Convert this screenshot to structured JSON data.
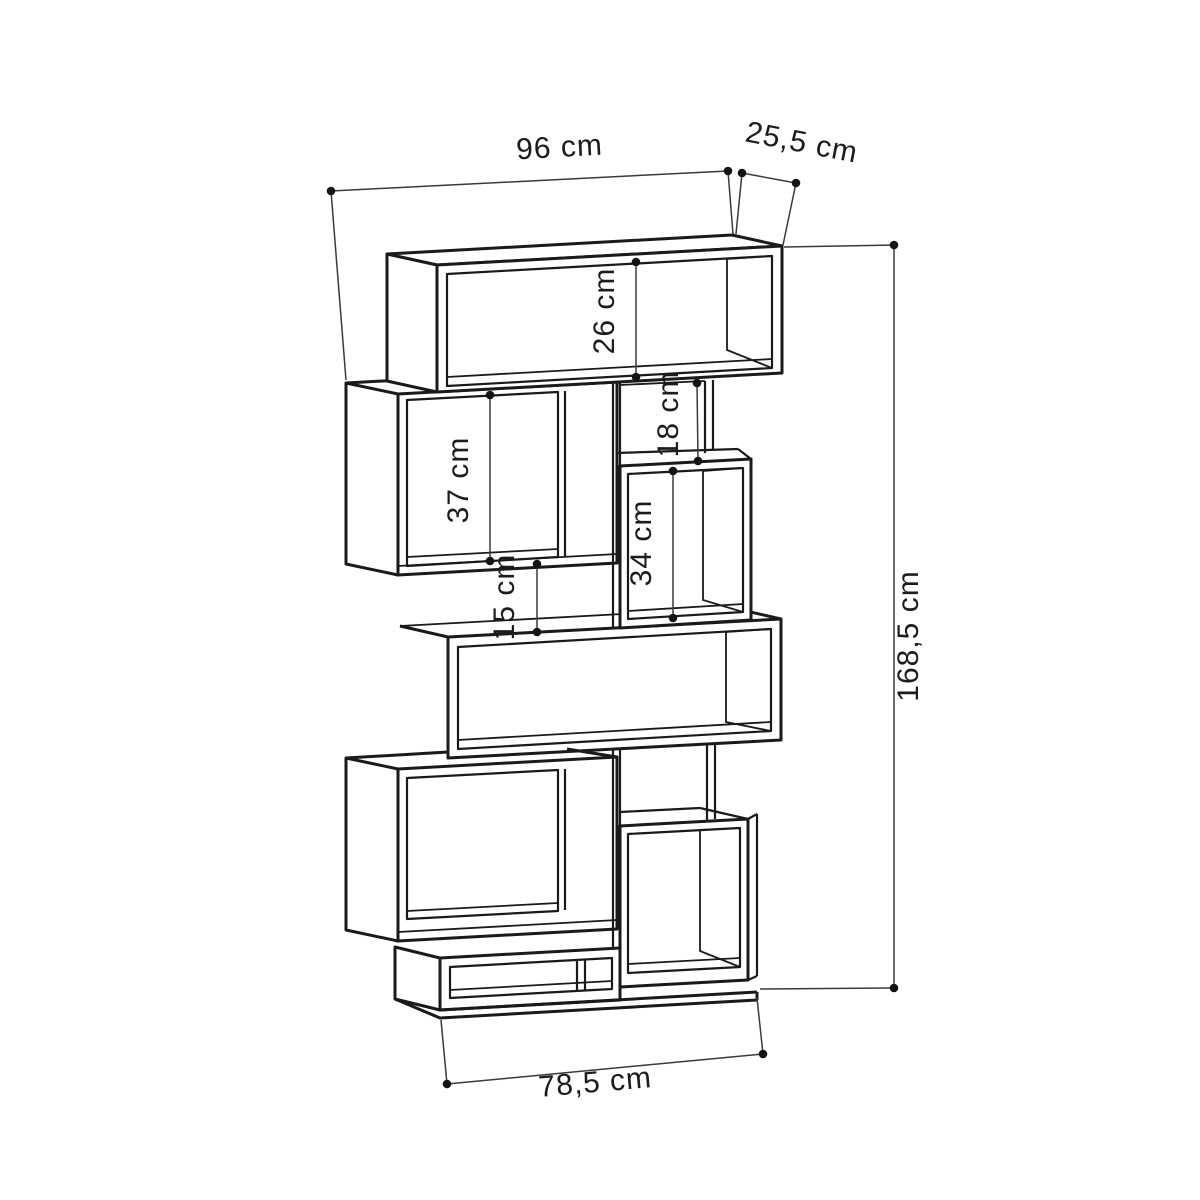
{
  "diagram": {
    "type": "furniture-dimension-drawing",
    "subject": "staggered cube bookcase",
    "background_color": "#ffffff",
    "line_color": "#1a1a1a",
    "dimension_line_color": "#3a3a3a",
    "text_color": "#1c1c1c",
    "unit": "cm",
    "dimensions": [
      {
        "name": "overall-width",
        "label": "96 cm",
        "value": "96",
        "unit": "cm",
        "orientation": "horizontal-top"
      },
      {
        "name": "depth",
        "label": "25,5 cm",
        "value": "25,5",
        "unit": "cm",
        "orientation": "oblique-top-right"
      },
      {
        "name": "top-compartment-height",
        "label": "26 cm",
        "value": "26",
        "unit": "cm",
        "orientation": "vertical"
      },
      {
        "name": "upper-left-compartment-height",
        "label": "37 cm",
        "value": "37",
        "unit": "cm",
        "orientation": "vertical"
      },
      {
        "name": "upper-middle-gap-height",
        "label": "18 cm",
        "value": "18",
        "unit": "cm",
        "orientation": "vertical"
      },
      {
        "name": "right-compartment-height",
        "label": "34 cm",
        "value": "34",
        "unit": "cm",
        "orientation": "vertical"
      },
      {
        "name": "middle-gap-height",
        "label": "15 cm",
        "value": "15",
        "unit": "cm",
        "orientation": "vertical"
      },
      {
        "name": "overall-height",
        "label": "168,5 cm",
        "value": "168,5",
        "unit": "cm",
        "orientation": "vertical-right"
      },
      {
        "name": "base-width",
        "label": "78,5 cm",
        "value": "78,5",
        "unit": "cm",
        "orientation": "horizontal-bottom"
      }
    ]
  }
}
